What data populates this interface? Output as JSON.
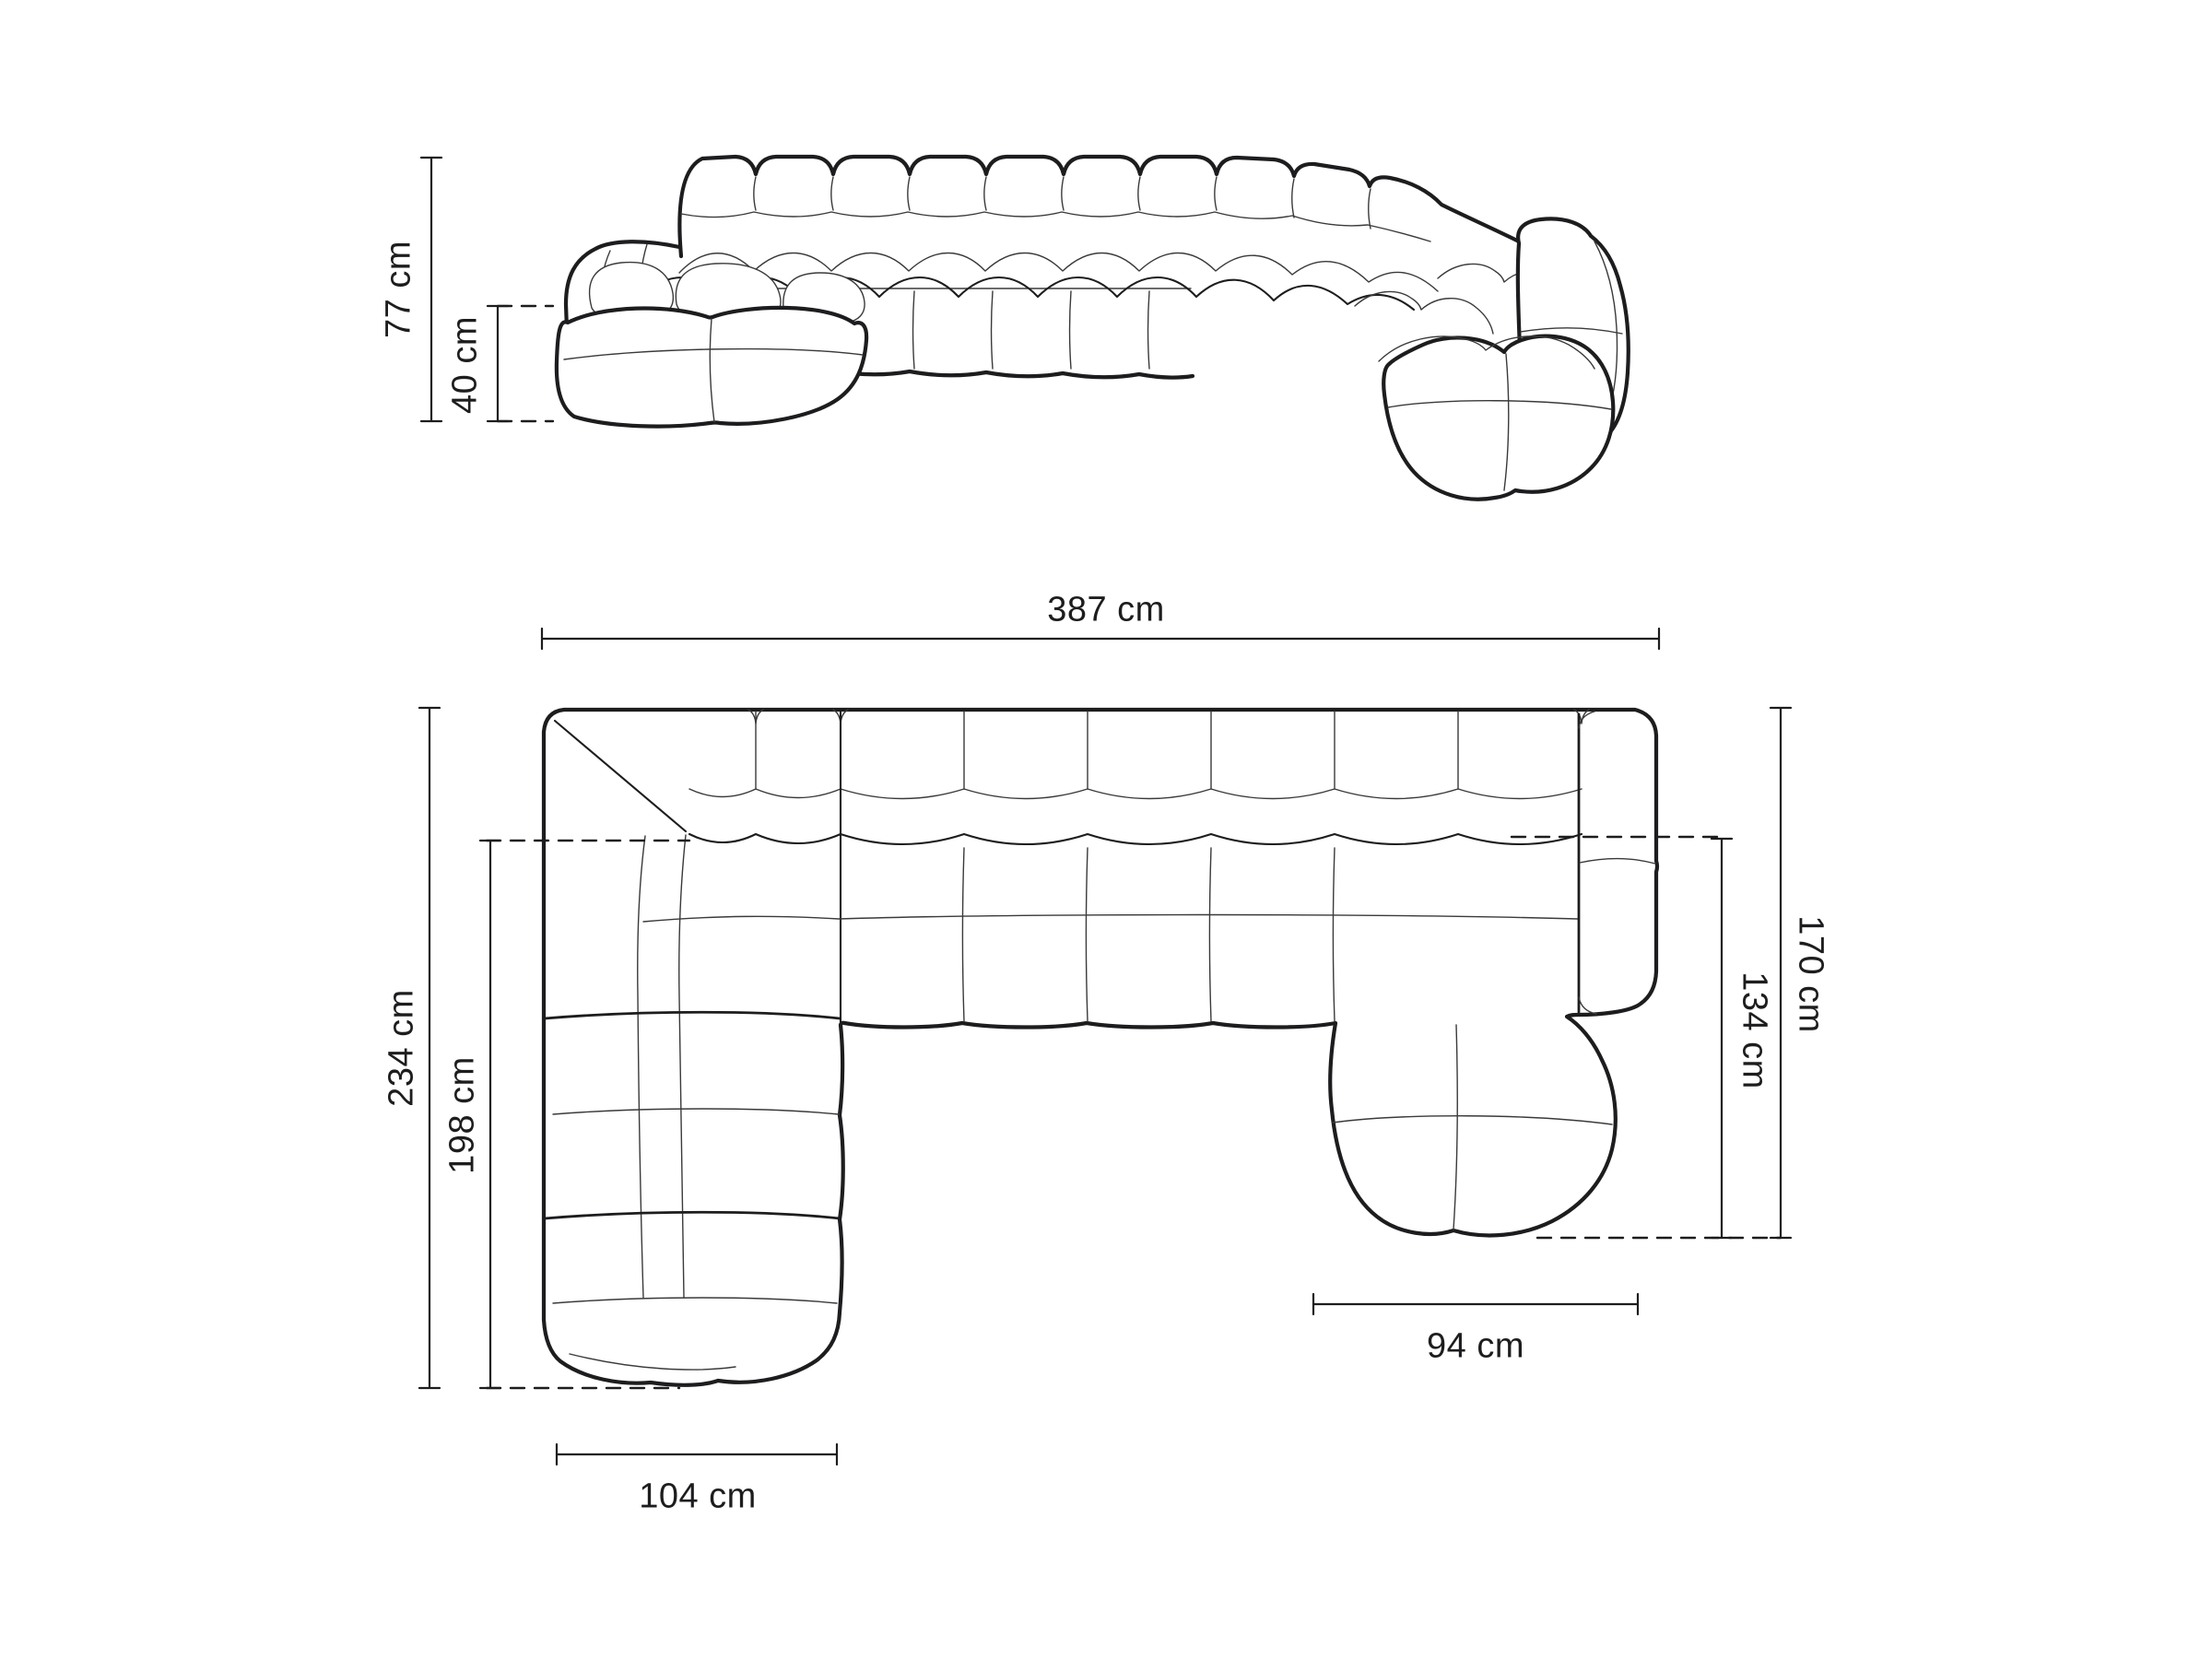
{
  "diagram": {
    "front_view": {
      "overall_height": "77 cm",
      "seat_height": "40 cm"
    },
    "top_view": {
      "overall_width": "387 cm",
      "left_side_depth": "234 cm",
      "left_chaise_length": "198 cm",
      "right_side_depth": "170 cm",
      "right_chaise_length": "134 cm",
      "right_chaise_width": "94 cm",
      "left_chaise_width": "104 cm"
    },
    "colors": {
      "line": "#1d1d1f",
      "background": "#ffffff"
    }
  }
}
